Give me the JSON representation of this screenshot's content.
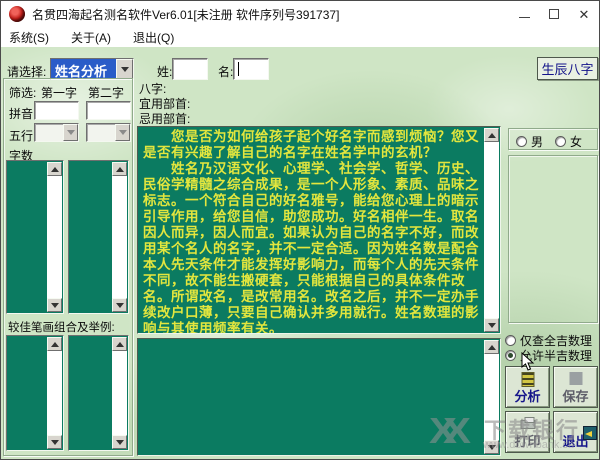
{
  "window": {
    "title": "名贯四海起名测名软件Ver6.01[未注册 软件序列号391737]",
    "controls": {
      "minimize": "─",
      "maximize": "□",
      "close": "✕"
    }
  },
  "menu": {
    "items": [
      {
        "label": "系统(S)"
      },
      {
        "label": "关于(A)"
      },
      {
        "label": "退出(Q)"
      }
    ]
  },
  "toolbar": {
    "select_label": "请选择:",
    "select_value": "姓名分析",
    "surname_label": "姓:",
    "surname_value": "",
    "given_label": "名:",
    "given_value": "",
    "bazi_button": "生辰八字"
  },
  "filter_panel": {
    "filter_label": "筛选:",
    "col1": "第一字",
    "col2": "第二字",
    "pinyin_label": "拼音",
    "wuxing_label": "五行",
    "zishu_label": "字数",
    "strokes_label": "较佳笔画组合及举例:"
  },
  "bazi_labels": {
    "bazi": "八字:",
    "yi": "宜用部首:",
    "ji": "忌用部首:"
  },
  "intro_text": "　　您是否为如何给孩子起个好名字而感到烦恼？您又是否有兴趣了解自己的名字在姓名学中的玄机？\n　　姓名乃汉语文化、心理学、社会学、哲学、历史、民俗学精髓之综合成果，是一个人形象、素质、品味之标志。一个符合自己的好名雅号，能给您心理上的暗示引导作用，给您自信，助您成功。好名相伴一生。取名因人而异，因人而宜。如果认为自己的名字不好，而改用某个名人的名字，并不一定合适。因为姓名数是配合本人先天条件才能发挥好影响力，而每个人的先天条件不同，故不能生搬硬套，只能根据自己的具体条件改名。所谓改名，是改常用名。改名之后，并不一定办手续改户口薄，只要自己确认并多用就行。姓名数理的影响与其使用频率有关。",
  "gender": {
    "male": "男",
    "female": "女"
  },
  "options": [
    {
      "label": "仅查全吉数理",
      "selected": false
    },
    {
      "label": "允许半吉数理",
      "selected": true
    }
  ],
  "buttons": {
    "analyze": "分析",
    "save": "保存",
    "print": "打印",
    "exit": "退出"
  },
  "watermark": {
    "logo": "XX",
    "name": "下载银行",
    "url": "www.downbank.cn"
  },
  "colors": {
    "teal_panel": "#0b7b61",
    "intro_text": "#e3e63e",
    "combo_highlight": "#2a5cc8",
    "button_text": "#14148a",
    "marble_bg": "#cfe5c5"
  }
}
